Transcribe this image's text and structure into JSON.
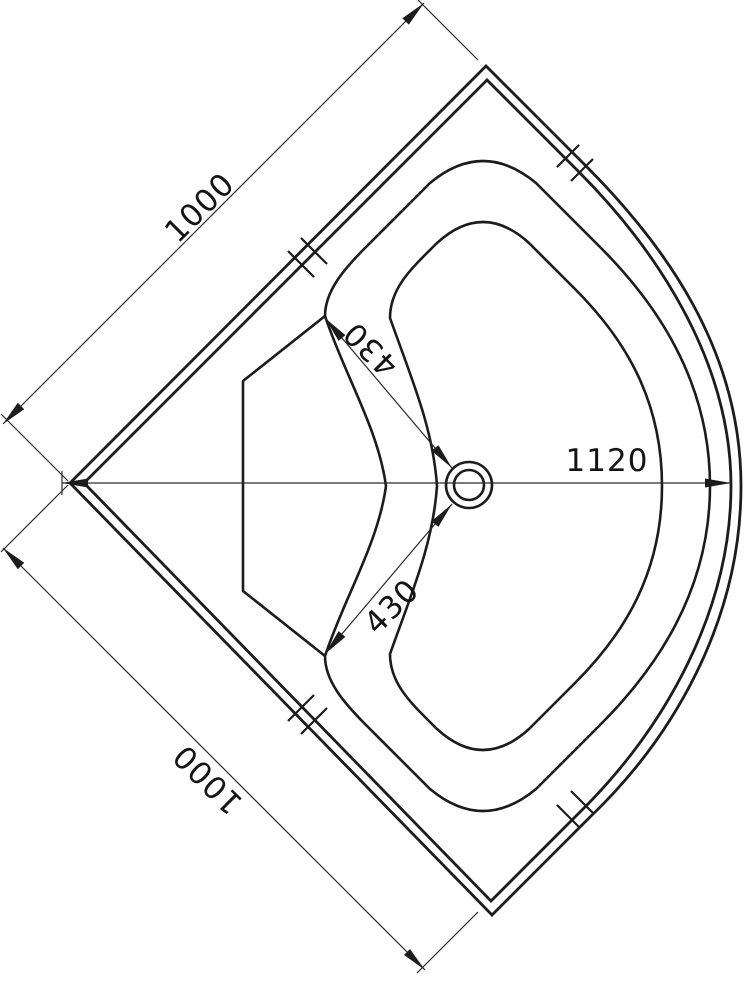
{
  "page": {
    "background": "#ffffff",
    "line_color": "#1c1c1c"
  },
  "drawing": {
    "type": "technical-drawing",
    "subject": "quadrant shower tray - top view",
    "dimensions": {
      "top_edge_length": "1000",
      "bottom_edge_length": "1000",
      "diagonal_length": "1120",
      "drain_to_seat_top": "430",
      "drain_to_seat_bottom": "430"
    }
  }
}
